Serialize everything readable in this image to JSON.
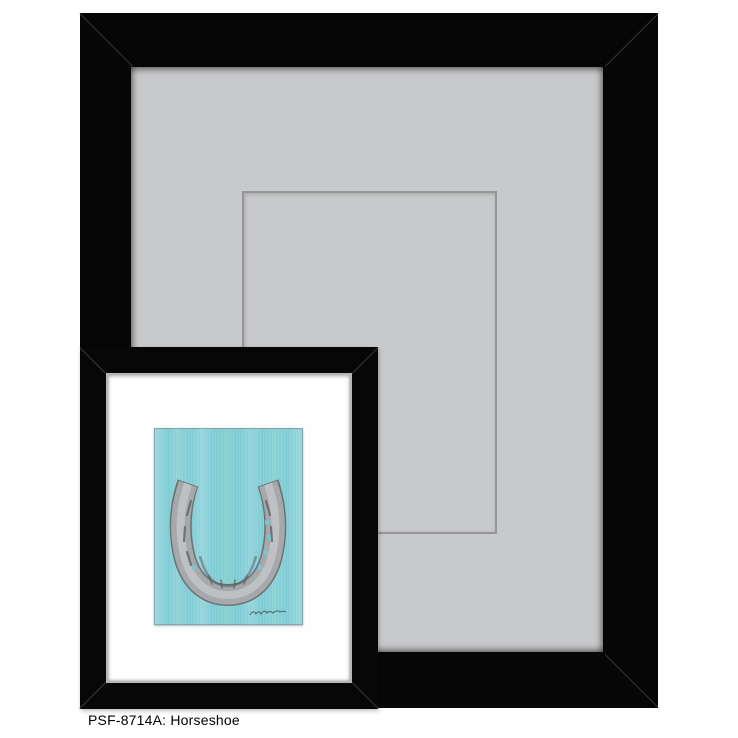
{
  "product": {
    "caption_text": "PSF-8714A: Horseshoe",
    "sku": "PSF-8714A",
    "title": "Horseshoe"
  },
  "scene": {
    "large_frame": {
      "style": "wide flat black frame with mitered corners",
      "mat": "light gray mat with beveled inner edge",
      "mat_opening": "thin gray outlined rectangle marking mat window"
    },
    "inset_frame": {
      "style": "black frame with thin silver lip and white mat",
      "artwork_subject": "gray horseshoe, heels up, on teal brushstroke background",
      "signature": "illegible artist signature, lower right of canvas"
    },
    "colors": {
      "background": "#ffffff",
      "frame_black": "#060606",
      "miter_line": "#5f5f5f",
      "mat_gray": "#c8c9ca",
      "mat_opening_line": "#95969a",
      "silver_lip": "#b4b6b8",
      "inset_mat_white": "#fefefe",
      "canvas_teal": "#7fccd5",
      "horseshoe_gray": "#a6a8ab",
      "horseshoe_edge_gray": "#6f7275",
      "caption_text_color": "#000000"
    }
  }
}
